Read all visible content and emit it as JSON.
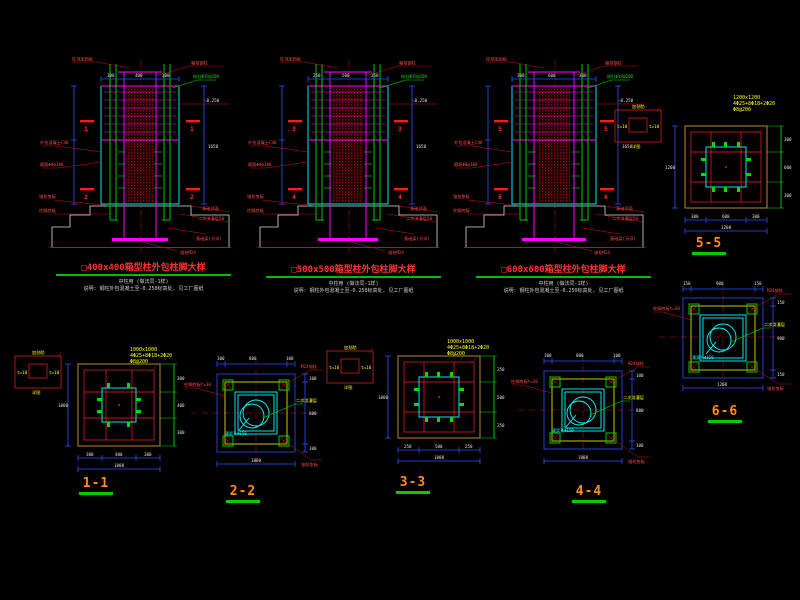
{
  "canvas": {
    "background": "#000000",
    "type": "cad-structural-drawing"
  },
  "colors": {
    "steel": "#ff00ff",
    "rebar": "#00dd00",
    "concrete_outline": "#00ffff",
    "dimension": "#2850ff",
    "annotation_red": "#ff2222",
    "note_yellow": "#ffff00",
    "foundation_white": "#dcdcdc",
    "title_red": "#ff3030",
    "section_title_orange": "#ff8c1e",
    "underline_green": "#00bb00"
  },
  "elevations": [
    {
      "title": "□400x400箱型柱外包柱脚大样",
      "subtitle1": "中柱用 (做法同-1样)",
      "subtitle2": "说明: 钢柱外包混凝土至-0.250标高处, 见工厂图纸",
      "marker_top": "1",
      "marker_bottom": "2",
      "dim_top_left": "300",
      "dim_top_mid": "400",
      "dim_top_right": "300",
      "dim_height": "1650"
    },
    {
      "title": "□500x500箱型柱外包柱脚大样",
      "subtitle1": "中柱用 (做法同-1样)",
      "subtitle2": "说明: 钢柱外包混凝土至-0.250标高处, 见工厂图纸",
      "marker_top": "3",
      "marker_bottom": "4",
      "dim_top_left": "250",
      "dim_top_mid": "500",
      "dim_top_right": "250",
      "dim_height": "1650"
    },
    {
      "title": "□600x600箱型柱外包柱脚大样",
      "subtitle1": "中柱用 (做法同-1样)",
      "subtitle2": "说明: 钢柱外包混凝土至-0.250标高处, 见工厂图纸",
      "marker_top": "5",
      "marker_bottom": "6",
      "dim_top_left": "300",
      "dim_top_mid": "600",
      "dim_top_right": "300",
      "dim_height": "1650"
    }
  ],
  "elevation_labels": {
    "top_left": "柱顶加劲板",
    "top_right": "箱型钢柱",
    "green_note": "栓钉Φ19@200",
    "right_level": "-0.250",
    "right_found": "基础顶面",
    "right_grout": "二次浇灌层50",
    "left_encase": "外包混凝土C40",
    "left_tie": "箍筋Φ8@100",
    "left_washer": "锚栓垫板",
    "left_plate": "柱脚底板",
    "br_beam": "基础梁(另详)",
    "b_anchor": "锚栓M24"
  },
  "sections": [
    {
      "title": "1-1",
      "note_l1": "1000x1000",
      "note_l2": "4Φ25+8Φ18+2Φ20",
      "note_l3": "Φ8@200",
      "dim_b1": "300",
      "dim_b2": "400",
      "dim_b3": "300",
      "dim_total": "1000",
      "dim_side": "1000"
    },
    {
      "title": "2-2",
      "dim_b1": "100",
      "dim_b2": "800",
      "dim_b3": "100",
      "dim_total": "1000"
    },
    {
      "title": "3-3",
      "note_l1": "1000x1000",
      "note_l2": "4Φ25+8Φ18+2Φ20",
      "note_l3": "Φ8@200",
      "dim_b1": "250",
      "dim_b2": "500",
      "dim_b3": "250",
      "dim_total": "1000",
      "dim_side": "1000"
    },
    {
      "title": "4-4",
      "dim_b1": "100",
      "dim_b2": "800",
      "dim_b3": "100",
      "dim_total": "1000"
    },
    {
      "title": "5-5",
      "note_l1": "1200x1200",
      "note_l2": "4Φ25+8Φ18+2Φ20",
      "note_l3": "Φ8@200",
      "dim_b1": "300",
      "dim_b2": "600",
      "dim_b3": "300",
      "dim_total": "1200",
      "dim_side": "1200"
    },
    {
      "title": "6-6",
      "dim_b1": "150",
      "dim_b2": "900",
      "dim_b3": "150",
      "dim_total": "1200"
    }
  ],
  "plan_labels": {
    "grout": "二次浇灌层",
    "hole": "灌浆孔Φ150",
    "anchor": "M24锚栓",
    "washer": "锚栓垫板",
    "plate": "柱脚底板t=30"
  },
  "detail_box": {
    "top": "加劲肋",
    "left": "t=10",
    "right": "t=10",
    "bottom": "详图"
  }
}
